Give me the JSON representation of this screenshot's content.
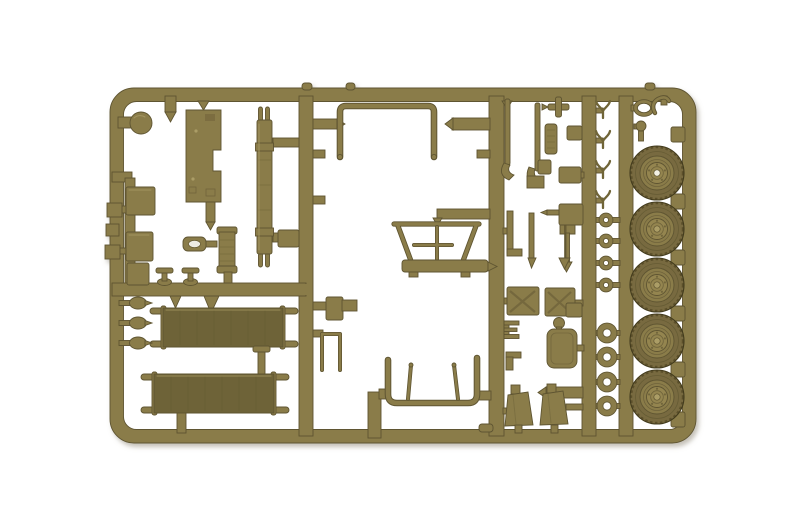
{
  "image": {
    "type": "product-photograph",
    "subject": "Olive drab injection-moulded plastic model kit parts sprue (military vehicle accessories: five road wheels, two stretchers, jerry cans, tools, tubular frames) on a white background",
    "background": "#ffffff"
  },
  "colors": {
    "plastic": "#8a7c4a",
    "light": "#ab9d66",
    "dark": "#5e5430",
    "deep": "#433b1e",
    "canvas": "#6e6437",
    "tire": "#786b3f",
    "hub": "#948550",
    "hole": "#f3f0e3"
  },
  "sprue": {
    "frame": {
      "x": 110,
      "y": 88,
      "width": 586,
      "height": 355,
      "corner_radius": 24,
      "rail_thickness": 13
    },
    "wheels": {
      "cx": 657,
      "cys": [
        173,
        229,
        285,
        341,
        397
      ],
      "radius": 27
    },
    "small_rings": {
      "cx": 606,
      "cys": [
        220,
        241,
        263,
        285
      ],
      "outer_radius": 6.5,
      "inner_radius": 3
    },
    "large_rings": {
      "cx": 607,
      "cys": [
        333,
        357,
        382,
        406
      ],
      "outer_radius": 9.5,
      "inner_radius": 4.5
    },
    "clamps": {
      "cx": 603,
      "cys": [
        109,
        139,
        169,
        199
      ]
    },
    "left_knobs": {
      "cx": 138,
      "cys": [
        303,
        323,
        343
      ]
    },
    "rail_blocks": {
      "x": 671,
      "ys": [
        127,
        194,
        250,
        306,
        362,
        412
      ]
    },
    "valves": {
      "xs": [
        156,
        182
      ],
      "y": 268
    },
    "inventory": [
      {
        "part": "road wheel",
        "count": 5
      },
      {
        "part": "stretcher",
        "count": 2
      },
      {
        "part": "jerry can",
        "count": 2
      },
      {
        "part": "small ring",
        "count": 4
      },
      {
        "part": "large ring",
        "count": 4
      },
      {
        "part": "spring clamp",
        "count": 4
      },
      {
        "part": "storage box",
        "count": 5
      },
      {
        "part": "tubular bow frame",
        "count": 2
      },
      {
        "part": "funnel frame",
        "count": 1
      },
      {
        "part": "floor panel",
        "count": 1
      },
      {
        "part": "pronged spring bar",
        "count": 1
      },
      {
        "part": "shovel",
        "count": 1
      },
      {
        "part": "axe",
        "count": 1
      },
      {
        "part": "seat cushion",
        "count": 1
      },
      {
        "part": "dome knob",
        "count": 1
      },
      {
        "part": "tow ring",
        "count": 1
      },
      {
        "part": "hook",
        "count": 1
      }
    ]
  }
}
